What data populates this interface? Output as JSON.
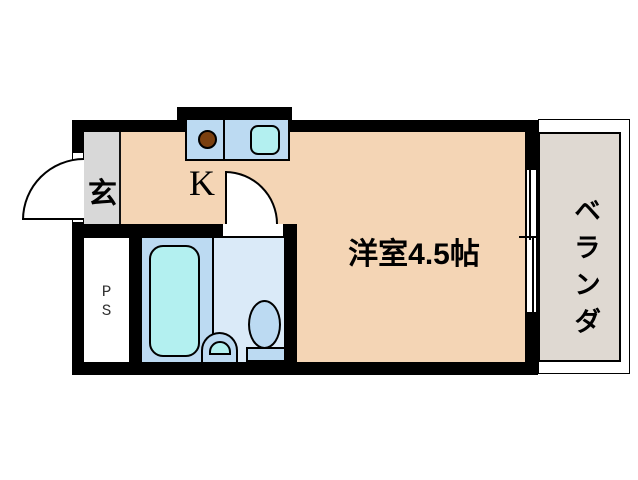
{
  "floor_plan": {
    "rooms": {
      "entrance": {
        "label": "玄"
      },
      "kitchen": {
        "label": "K"
      },
      "western_room": {
        "label": "洋室4.5帖"
      },
      "veranda": {
        "label": "ベランダ"
      },
      "pipe_space": {
        "line1": "P",
        "line2": "S"
      }
    },
    "fixtures": {
      "bathtub": "bathtub",
      "wash_basin": "wash-basin",
      "toilet": "toilet",
      "stove_burner": "stove-burner",
      "kitchen_sink": "kitchen-sink",
      "entrance_door": "entrance-door-swing",
      "bathroom_door": "bathroom-door-swing",
      "window": "sliding-window"
    },
    "colors": {
      "wall": "#000000",
      "floor": "#F4D5B5",
      "entrance": "#D8D8D8",
      "veranda": "#DFD9D2",
      "bath": "#BCDAF2",
      "sanitary": "#DAEAF8",
      "water": "#B3F0F0",
      "stove": "#7B4010"
    }
  }
}
